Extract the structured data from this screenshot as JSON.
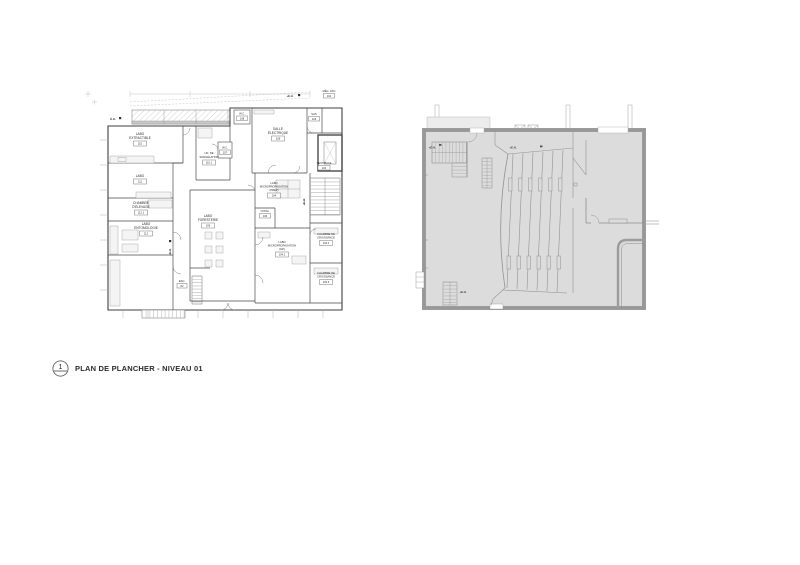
{
  "drawing": {
    "background": "#ffffff",
    "line_color": "#4a4a4a",
    "gray_fill": "#dcdcdc",
    "gray_wall": "#9e9e9e"
  },
  "title_block": {
    "callout_number": "1",
    "title": "PLAN DE PLANCHER - NIVEAU 01"
  },
  "left_plan": {
    "rooms": [
      {
        "name_lines": [
          "LABO",
          "EXTRACTIBLE"
        ],
        "number": "110"
      },
      {
        "name_lines": [
          "LABO"
        ],
        "number": "111"
      },
      {
        "name_lines": [
          "CHAMBRE",
          "D'ÉLEVAGE"
        ],
        "number": "112.1"
      },
      {
        "name_lines": [
          "LABO",
          "ENTOMOLOGIE"
        ],
        "number": "112"
      },
      {
        "name_lines": [
          "UN. DE",
          "SURGÉLATION"
        ],
        "number": "110.1"
      },
      {
        "name_lines": [
          "W.C."
        ],
        "number": "108"
      },
      {
        "name_lines": [
          "W.C."
        ],
        "number": "107"
      },
      {
        "name_lines": [
          "SALLE",
          "ÉLECTRIQUE"
        ],
        "number": "105"
      },
      {
        "name_lines": [
          "SAS"
        ],
        "number": "103"
      },
      {
        "name_lines": [
          "MÉC. ASC"
        ],
        "number": "101"
      },
      {
        "name_lines": [
          "VESTIBULE"
        ],
        "number": "102"
      },
      {
        "name_lines": [
          "LABO",
          "MICROPROPAGATION",
          "(PREP)"
        ],
        "number": "104"
      },
      {
        "name_lines": [
          "CONG."
        ],
        "number": "106"
      },
      {
        "name_lines": [
          "LABO",
          "FORESTERIE"
        ],
        "number": "109"
      },
      {
        "name_lines": [
          "LABO",
          "MICROPROPAGATION",
          "(GP.)"
        ],
        "number": "104.1"
      },
      {
        "name_lines": [
          "CHAMBRE DE",
          "CROISSANCE"
        ],
        "number": "104.2"
      },
      {
        "name_lines": [
          "CHAMBRE DE",
          "CROISSANCE"
        ],
        "number": "104.3"
      },
      {
        "name_lines": [
          "ESC."
        ],
        "number": "02"
      }
    ],
    "markers": {
      "eh": "É.H.",
      "eh_plus": "+E.H."
    }
  },
  "right_plan": {
    "markers": {
      "eh_plus": "+E.H."
    }
  }
}
